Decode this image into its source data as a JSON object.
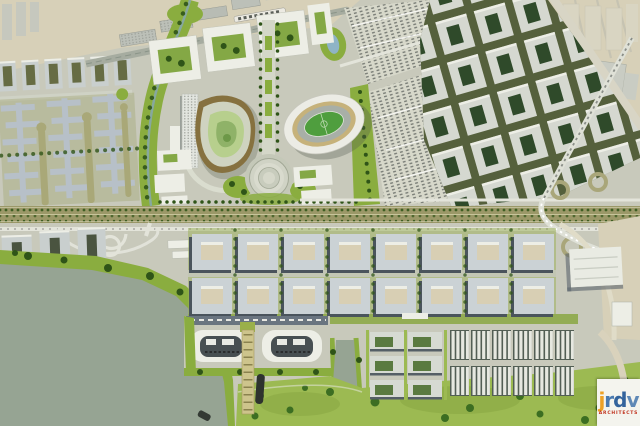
{
  "meta": {
    "title": "Aerial rendering of an urban waterfront master plan with ballpark, stadium and lake"
  },
  "palette": {
    "terrain": "#c8c9bb",
    "beige": "#d7d0b8",
    "park": "#8aad3f",
    "parkBright": "#9cba52",
    "treeDark": "#2f5418",
    "water": "#96a493",
    "highway": "#9b9868",
    "roadWhite": "#e3e4da",
    "roadOlive": "#a9a67a",
    "bldgGray": "#c9cfce",
    "bldgBlue": "#b7c0c8",
    "shadow": "#4a545c",
    "white": "#edeee6",
    "courtOlive": "#666c44",
    "courtGreen": "#2f4a2a",
    "courtBeige": "#d8cfb4",
    "campusGreen": "#84a845",
    "tan": "#c6b27b",
    "brown": "#86713f",
    "seat": "#a8afa7",
    "pitch": "#4f9e3e",
    "field": "#b7cf8d",
    "slate": "#6a7580",
    "pond": "#8fb4c6",
    "logoBox": "#f4f4ee"
  },
  "features": [
    "industrial-strip",
    "existing-city-grid",
    "linear-park-corridor",
    "residential-maze-district",
    "baseball-park",
    "oval-stadium",
    "central-axis-mall",
    "circular-plaza",
    "parking-fields",
    "courtyard-block-district",
    "highway-corridor",
    "interchange-ramps",
    "lake",
    "marina-pier",
    "waterfront-crescents",
    "canal",
    "southern-block-district",
    "row-housing",
    "waterfront-park",
    "architect-logo"
  ],
  "logo": {
    "word": "jrdv",
    "letters": [
      {
        "char": "j",
        "color": "#eda126"
      },
      {
        "char": "r",
        "color": "#4a7ab0"
      },
      {
        "char": "d",
        "color": "#33639c"
      },
      {
        "char": "v",
        "color": "#5e88b6"
      }
    ],
    "subtext": "ARCHITECTS",
    "subtext_color": "#c0321e"
  }
}
